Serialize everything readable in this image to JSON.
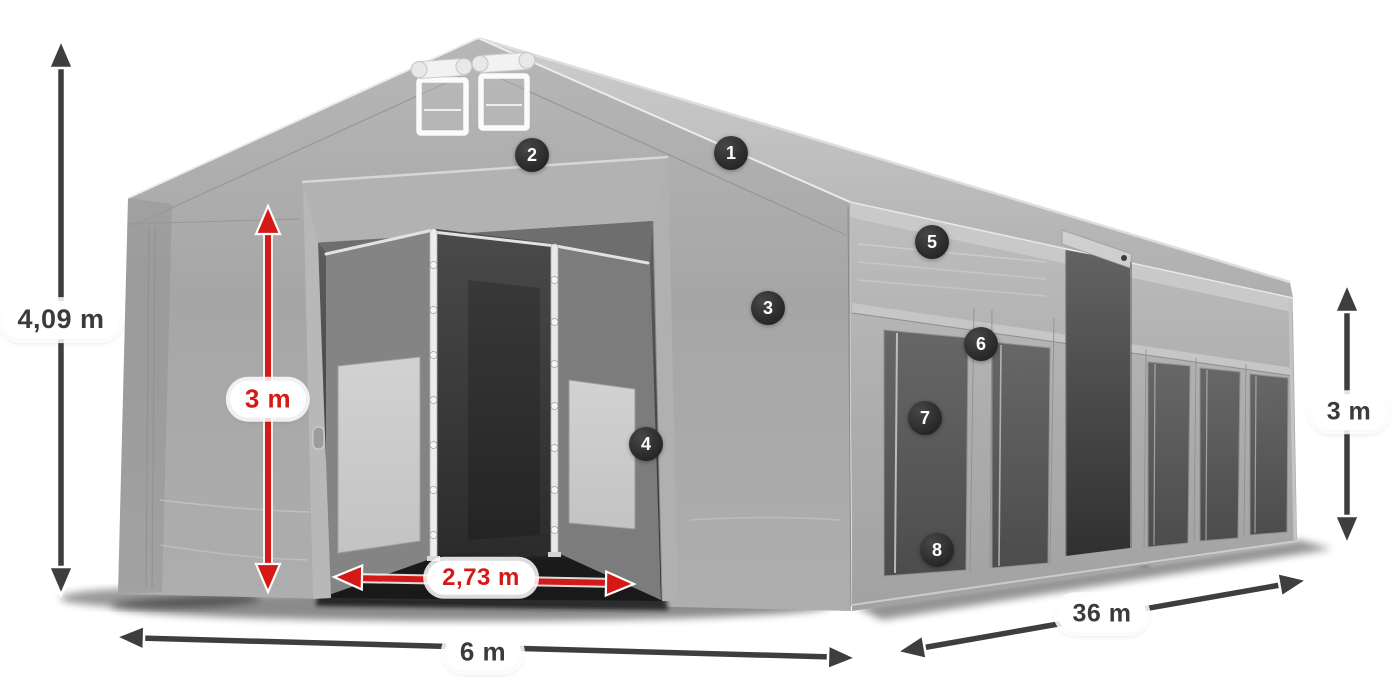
{
  "dimension_labels": {
    "total_height": "4,09 m",
    "entrance_height": "3 m",
    "entrance_width": "2,73 m",
    "front_width": "6 m",
    "side_length": "36 m",
    "side_wall_height": "3 m"
  },
  "feature_badges": [
    {
      "number": "1"
    },
    {
      "number": "2"
    },
    {
      "number": "3"
    },
    {
      "number": "4"
    },
    {
      "number": "5"
    },
    {
      "number": "6"
    },
    {
      "number": "7"
    },
    {
      "number": "8"
    }
  ],
  "colors": {
    "dimension_red": "#d31a17",
    "arrow_dark": "#3e3e3e",
    "label_dark": "#3b3b3b",
    "pill_background": "#ffffff",
    "badge_background": "#2b2b2b",
    "badge_text": "#ffffff",
    "tent_canvas_gray": "#a8a8a8",
    "page_background": "#ffffff"
  }
}
